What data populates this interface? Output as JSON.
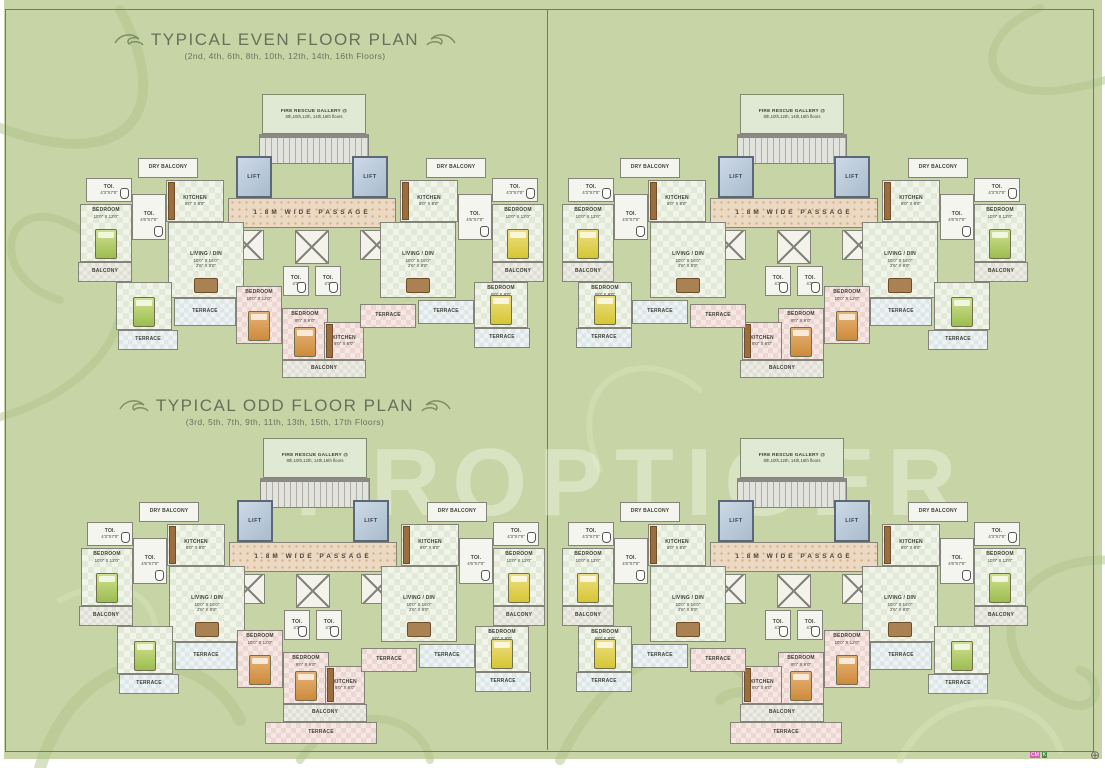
{
  "page": {
    "background": "#c7d4a6",
    "frame_color": "#6d7f57",
    "watermark": "PROPTIGER",
    "registration_mark": "⊕",
    "print_marks": [
      "CM",
      "K"
    ]
  },
  "sections": [
    {
      "title": "TYPICAL EVEN FLOOR PLAN",
      "subtitle": "(2nd, 4th, 6th, 8th, 10th, 12th, 14th, 16th Floors)"
    },
    {
      "title": "TYPICAL ODD FLOOR PLAN",
      "subtitle": "(3rd, 5th, 7th, 9th, 11th, 13th, 15th, 17th Floors)"
    }
  ],
  "plan": {
    "width": 468,
    "height": 288,
    "odd_height": 310,
    "rooms": [
      {
        "name": "fire-rescue-gallery",
        "type": "firebox",
        "x": 184,
        "y": 2,
        "w": 104,
        "h": 40,
        "label": "FIRE RESCUE GALLERY @",
        "line2": "8th,10th,12th, 14th,16th floors"
      },
      {
        "name": "staircase",
        "type": "stairs",
        "x": 181,
        "y": 42,
        "w": 110,
        "h": 30
      },
      {
        "name": "lift-left",
        "type": "lift",
        "x": 158,
        "y": 64,
        "w": 36,
        "h": 42,
        "label": "LIFT"
      },
      {
        "name": "lift-right",
        "type": "lift",
        "x": 274,
        "y": 64,
        "w": 36,
        "h": 42,
        "label": "LIFT"
      },
      {
        "name": "passage",
        "type": "passage",
        "x": 150,
        "y": 106,
        "w": 168,
        "h": 30,
        "label": "1.8M WIDE PASSAGE"
      },
      {
        "name": "duct",
        "type": "duct",
        "x": 152,
        "y": 138,
        "w": 34,
        "h": 30
      },
      {
        "name": "duct",
        "type": "duct",
        "x": 217,
        "y": 138,
        "w": 34,
        "h": 34
      },
      {
        "name": "duct",
        "type": "duct",
        "x": 282,
        "y": 138,
        "w": 34,
        "h": 30
      },
      {
        "name": "toilet",
        "type": "white",
        "x": 205,
        "y": 174,
        "w": 26,
        "h": 30,
        "label": "TOI.",
        "dims": "4'3\"",
        "wc": true
      },
      {
        "name": "toilet",
        "type": "white",
        "x": 237,
        "y": 174,
        "w": 26,
        "h": 30,
        "label": "TOI.",
        "dims": "4'3\"",
        "wc": true
      },
      {
        "name": "dry-balcony",
        "type": "white",
        "x": 60,
        "y": 66,
        "w": 60,
        "h": 20,
        "label": "DRY BALCONY"
      },
      {
        "name": "toilet",
        "type": "white",
        "x": 8,
        "y": 86,
        "w": 46,
        "h": 24,
        "label": "TOI.",
        "dims": "4'3\"X7'0\"",
        "wc": true
      },
      {
        "name": "kitchen",
        "type": "check",
        "x": 88,
        "y": 88,
        "w": 58,
        "h": 42,
        "label": "KITCHEN",
        "dims": "8'0\" X 8'0\"",
        "counter": true
      },
      {
        "name": "toilet",
        "type": "white",
        "x": 54,
        "y": 102,
        "w": 34,
        "h": 46,
        "label": "TOI.",
        "dims": "4'6\"X7'0\"",
        "wc": true
      },
      {
        "name": "bedroom",
        "type": "check",
        "x": 2,
        "y": 112,
        "w": 52,
        "h": 58,
        "label": "BEDROOM",
        "dims": "10'0\" X 12'0\"",
        "bed": "green"
      },
      {
        "name": "living-dining",
        "type": "check",
        "x": 90,
        "y": 130,
        "w": 76,
        "h": 76,
        "label": "LIVING / DIN",
        "dims": "10'0\" X 16'0\"",
        "dims2": "2'6\" X 8'0\"",
        "furn": true
      },
      {
        "name": "balcony",
        "type": "balc",
        "x": 0,
        "y": 170,
        "w": 54,
        "h": 20,
        "label": "BALCONY"
      },
      {
        "name": "bedroom",
        "type": "check",
        "x": 38,
        "y": 190,
        "w": 56,
        "h": 48,
        "bed": "green"
      },
      {
        "name": "terrace",
        "type": "terr",
        "x": 40,
        "y": 238,
        "w": 60,
        "h": 20,
        "label": "TERRACE"
      },
      {
        "name": "terrace",
        "type": "terr",
        "x": 96,
        "y": 206,
        "w": 62,
        "h": 28,
        "label": "TERRACE"
      },
      {
        "name": "bedroom",
        "type": "pink",
        "x": 158,
        "y": 194,
        "w": 46,
        "h": 58,
        "label": "BEDROOM",
        "dims": "10'0\" X 12'0\"",
        "bed": "orange"
      },
      {
        "name": "bedroom",
        "type": "pink",
        "x": 204,
        "y": 216,
        "w": 46,
        "h": 52,
        "label": "BEDROOM",
        "dims": "9'0\" X 9'0\"",
        "bed": "orange"
      },
      {
        "name": "kitchen",
        "type": "pink",
        "x": 246,
        "y": 230,
        "w": 40,
        "h": 38,
        "label": "KITCHEN",
        "dims": "8'0\" X 8'0\"",
        "counter": true
      },
      {
        "name": "terrace",
        "type": "pink",
        "x": 282,
        "y": 212,
        "w": 56,
        "h": 24,
        "label": "TERRACE"
      },
      {
        "name": "balcony",
        "type": "balc",
        "x": 204,
        "y": 268,
        "w": 84,
        "h": 18,
        "label": "BALCONY"
      },
      {
        "name": "dry-balcony",
        "type": "white",
        "x": 348,
        "y": 66,
        "w": 60,
        "h": 20,
        "label": "DRY BALCONY"
      },
      {
        "name": "toilet",
        "type": "white",
        "x": 414,
        "y": 86,
        "w": 46,
        "h": 24,
        "label": "TOI.",
        "dims": "4'3\"X7'0\"",
        "wc": true
      },
      {
        "name": "kitchen",
        "type": "check",
        "x": 322,
        "y": 88,
        "w": 58,
        "h": 42,
        "label": "KITCHEN",
        "dims": "8'0\" X 8'0\"",
        "counter": true
      },
      {
        "name": "toilet",
        "type": "white",
        "x": 380,
        "y": 102,
        "w": 34,
        "h": 46,
        "label": "TOI.",
        "dims": "4'6\"X7'0\"",
        "wc": true
      },
      {
        "name": "bedroom",
        "type": "check",
        "x": 414,
        "y": 112,
        "w": 52,
        "h": 58,
        "label": "BEDROOM",
        "dims": "10'0\" X 12'0\"",
        "bed": "yellow"
      },
      {
        "name": "living-dining",
        "type": "check",
        "x": 302,
        "y": 130,
        "w": 76,
        "h": 76,
        "label": "LIVING / DIN",
        "dims": "10'0\" X 16'0\"",
        "dims2": "2'6\" X 8'0\"",
        "furn": true
      },
      {
        "name": "balcony",
        "type": "balc",
        "x": 414,
        "y": 170,
        "w": 52,
        "h": 20,
        "label": "BALCONY"
      },
      {
        "name": "terrace",
        "type": "terr",
        "x": 340,
        "y": 208,
        "w": 56,
        "h": 24,
        "label": "TERRACE"
      },
      {
        "name": "bedroom",
        "type": "check",
        "x": 396,
        "y": 190,
        "w": 54,
        "h": 46,
        "label": "BEDROOM",
        "dims": "9'0\" X 9'0\"",
        "bed": "yellow"
      },
      {
        "name": "terrace",
        "type": "terr",
        "x": 396,
        "y": 236,
        "w": 56,
        "h": 20,
        "label": "TERRACE"
      }
    ],
    "odd_extra_rooms": [
      {
        "name": "terrace",
        "type": "pink",
        "x": 186,
        "y": 286,
        "w": 112,
        "h": 22,
        "label": "TERRACE"
      }
    ]
  },
  "clusters": [
    {
      "section": 0,
      "x": 78,
      "y": 92,
      "mirror": false,
      "odd": false
    },
    {
      "section": 0,
      "x": 560,
      "y": 92,
      "mirror": true,
      "odd": false
    },
    {
      "section": 1,
      "x": 79,
      "y": 436,
      "mirror": false,
      "odd": true
    },
    {
      "section": 1,
      "x": 560,
      "y": 436,
      "mirror": true,
      "odd": true
    }
  ]
}
